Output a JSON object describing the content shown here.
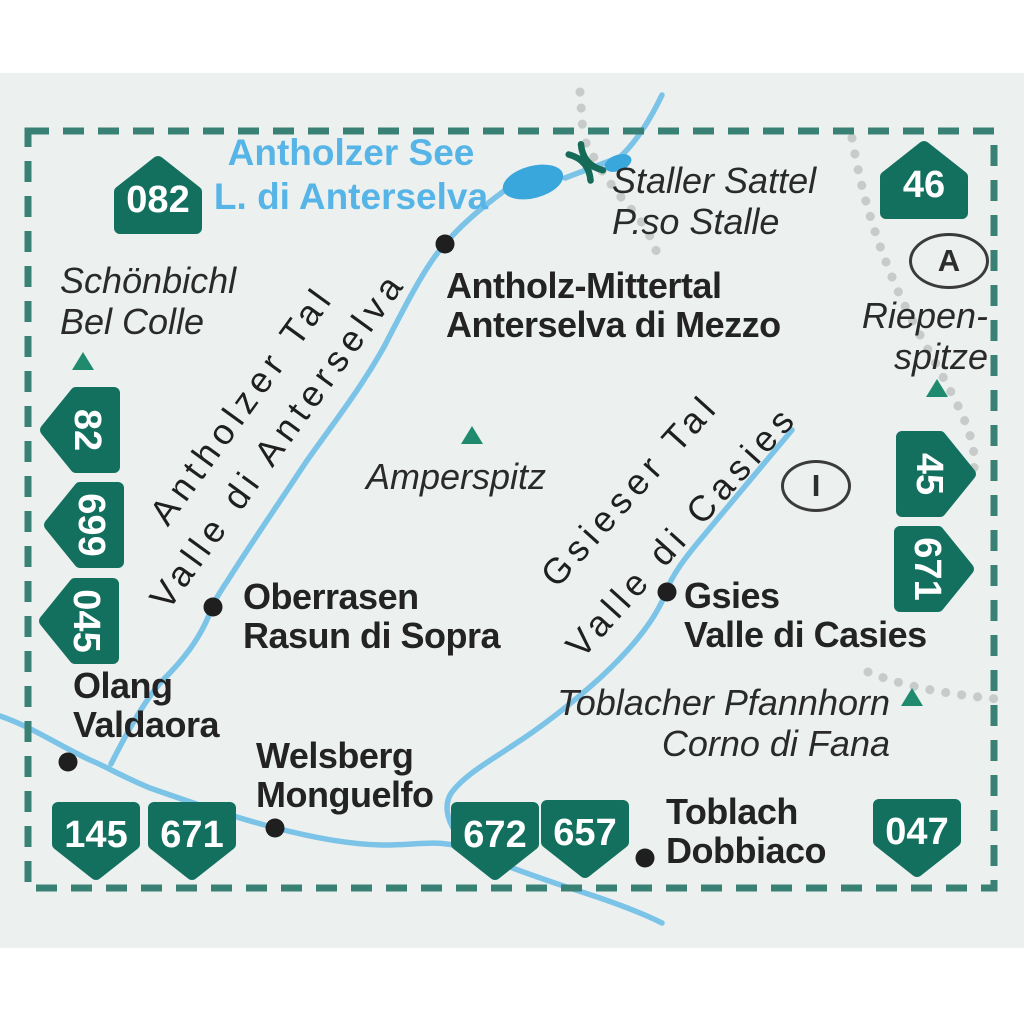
{
  "colors": {
    "badge_green": "#14705e",
    "border_dash_teal": "#3a8175",
    "river_blue": "#7cc3e8",
    "lake_blue": "#39a7dc",
    "lake_label_blue": "#57b4e6",
    "text_dark": "#232323",
    "map_background": "#ecf1ef",
    "boundary_dot_gray": "#c7cbca",
    "peak_triangle_green": "#1f8a6d"
  },
  "lake_label": {
    "de": "Antholzer See",
    "it": "L. di Anterselva"
  },
  "pass_label": {
    "de": "Staller Sattel",
    "it": "P.so Stalle"
  },
  "peaks": {
    "schoenbichl": {
      "de": "Schönbichl",
      "it": "Bel Colle"
    },
    "amperspitz": {
      "name": "Amperspitz"
    },
    "riepenspitze": {
      "line1": "Riepen-",
      "line2": "spitze"
    },
    "pfannhorn": {
      "de": "Toblacher Pfannhorn",
      "it": "Corno di Fana"
    }
  },
  "towns": {
    "antholz_mittertal": {
      "de": "Antholz-Mittertal",
      "it": "Anterselva di Mezzo"
    },
    "oberrasen": {
      "de": "Oberrasen",
      "it": "Rasun di Sopra"
    },
    "gsies": {
      "de": "Gsies",
      "it": "Valle di Casies"
    },
    "olang": {
      "de": "Olang",
      "it": "Valdaora"
    },
    "welsberg": {
      "de": "Welsberg",
      "it": "Monguelfo"
    },
    "toblach": {
      "de": "Toblach",
      "it": "Dobbiaco"
    }
  },
  "valleys": {
    "antholzer": {
      "de": "Antholzer Tal",
      "it": "Valle di Anterselva"
    },
    "gsieser": {
      "de": "Gsieser Tal",
      "it": "Valle di Casies"
    }
  },
  "badges": {
    "b082": "082",
    "b46": "46",
    "b82": "82",
    "b699": "699",
    "b045": "045",
    "b45": "45",
    "b671_right": "671",
    "b145": "145",
    "b671_bottom": "671",
    "b672": "672",
    "b657": "657",
    "b047": "047"
  },
  "country_markers": {
    "austria": "A",
    "italy": "I"
  }
}
